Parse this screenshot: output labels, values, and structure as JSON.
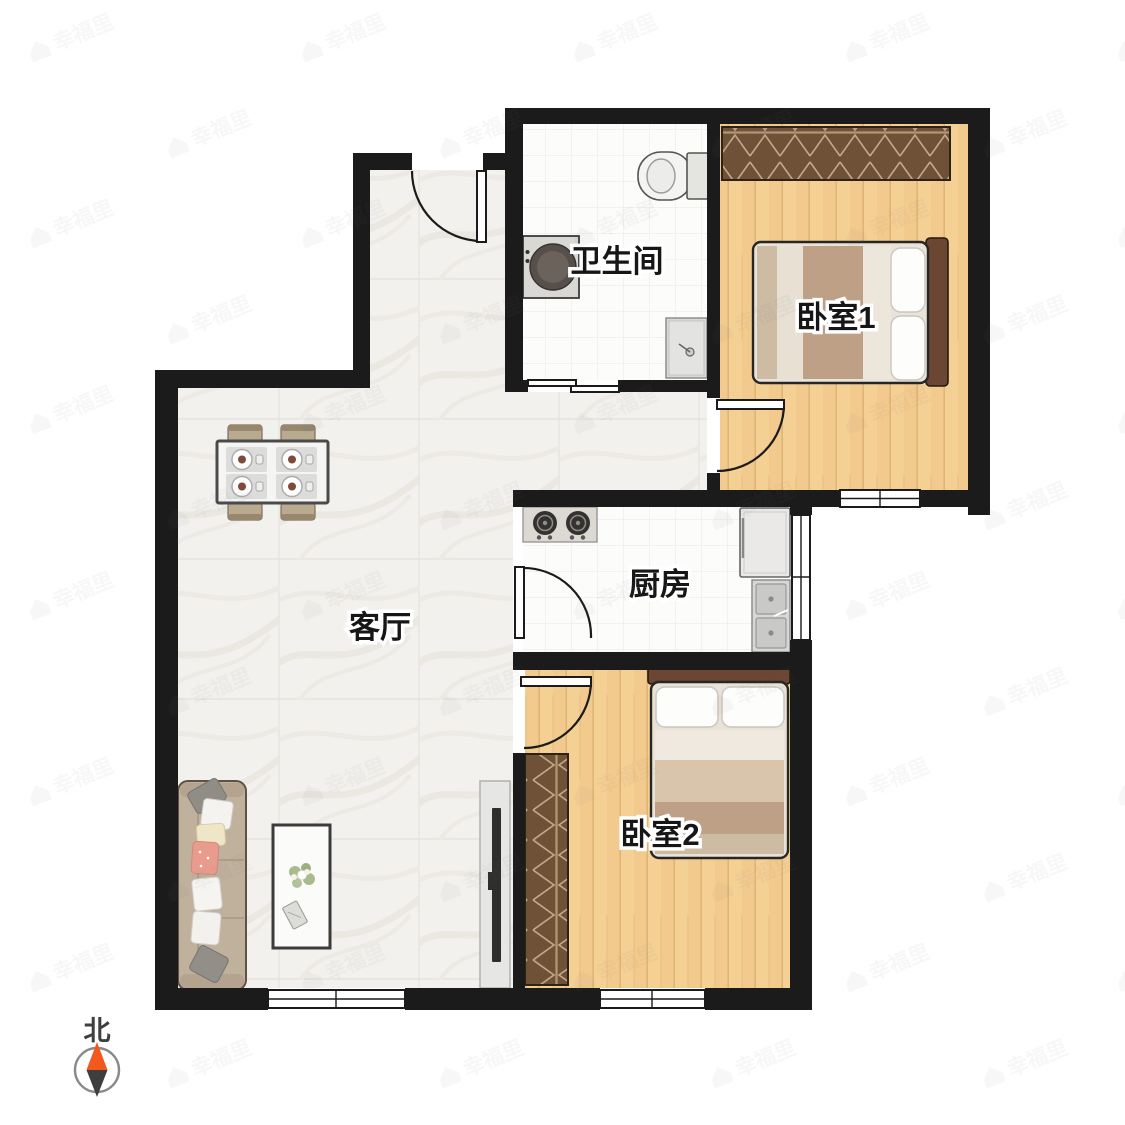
{
  "rooms": {
    "living_room": {
      "label": "客厅"
    },
    "kitchen": {
      "label": "厨房"
    },
    "bathroom": {
      "label": "卫生间"
    },
    "bedroom1": {
      "label": "卧室1"
    },
    "bedroom2": {
      "label": "卧室2"
    }
  },
  "compass": {
    "north_label": "北"
  },
  "watermark": {
    "text": "幸福里",
    "icon": "house-icon"
  },
  "colors": {
    "wall": "#1b1b1b",
    "wood_floor": "#f2ca8d",
    "marble_floor": "#f3f1ee",
    "tile_floor": "#fcfcfb",
    "wardrobe_brown": "#6f5138",
    "bed_headboard": "#6b4632",
    "sofa_tan": "#c0b19d",
    "compass_orange": "#f2591f",
    "compass_dark": "#3e3e3e"
  }
}
